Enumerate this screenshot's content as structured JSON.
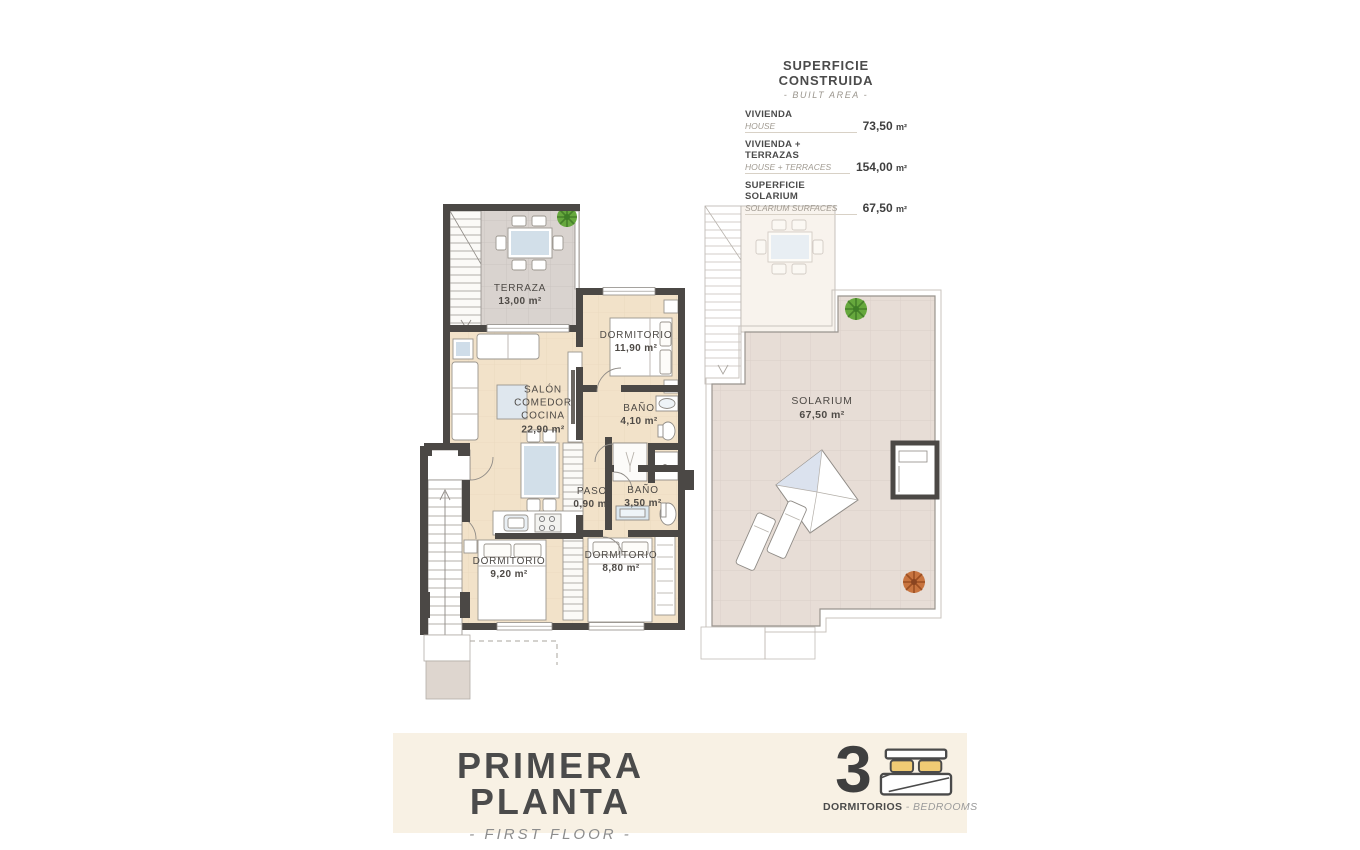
{
  "info_panel": {
    "title": "SUPERFICIE CONSTRUIDA",
    "subtitle": "- BUILT AREA -",
    "rows": [
      {
        "es": "VIVIENDA",
        "en": "HOUSE",
        "value": "73,50",
        "unit": "m²"
      },
      {
        "es": "VIVIENDA + TERRAZAS",
        "en": "HOUSE + TERRACES",
        "value": "154,00",
        "unit": "m²"
      },
      {
        "es": "SUPERFICIE SOLARIUM",
        "en": "SOLARIUM SURFACES",
        "value": "67,50",
        "unit": "m²"
      }
    ]
  },
  "plan": {
    "terraza": {
      "name": "TERRAZA",
      "area": "13,00 m²"
    },
    "salon": {
      "line1": "SALÓN",
      "line2": "COMEDOR",
      "line3": "COCINA",
      "area": "22,90 m²"
    },
    "dormitorio1": {
      "name": "DORMITORIO",
      "area": "11,90 m²"
    },
    "bano1": {
      "name": "BAÑO",
      "area": "4,10 m²"
    },
    "paso": {
      "name": "PASO",
      "area": "0,90 m²"
    },
    "bano2": {
      "name": "BAÑO",
      "area": "3,50 m²"
    },
    "dormitorio2": {
      "name": "DORMITORIO",
      "area": "9,20 m²"
    },
    "dormitorio3": {
      "name": "DORMITORIO",
      "area": "8,80 m²"
    },
    "solarium": {
      "name": "SOLARIUM",
      "area": "67,50 m²"
    }
  },
  "footer": {
    "title": "PRIMERA PLANTA",
    "subtitle": "- FIRST FLOOR -",
    "bedrooms_count": "3",
    "bedrooms_es": "DORMITORIOS",
    "bedrooms_en": "- BEDROOMS"
  },
  "colors": {
    "wall": "#4b4845",
    "floor": "#f2e2c9",
    "terrace_tile": "#d9d3cf",
    "solarium_tile": "#e7ddd6",
    "banner": "#f8f1e4",
    "pillow_yellow": "#f0cb74",
    "water_blue": "#d2dfe9",
    "plant_green": "#66a83d",
    "plant_orange": "#c8743f"
  }
}
